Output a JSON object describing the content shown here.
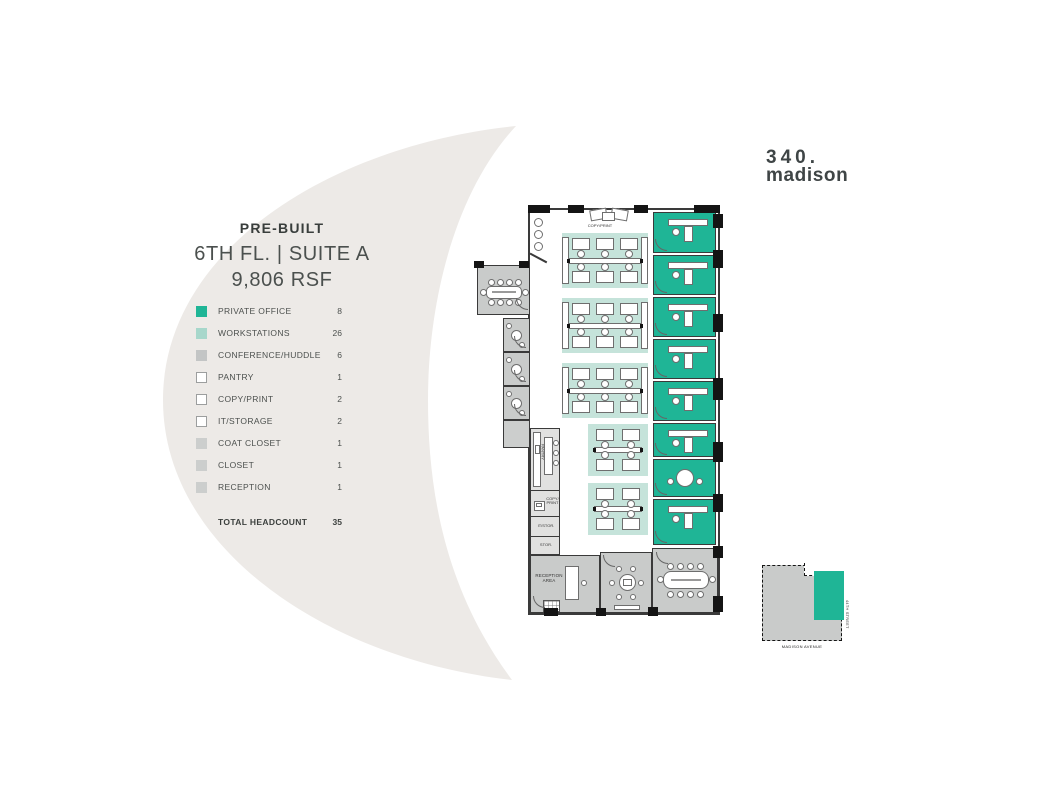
{
  "logo": {
    "line1": "340.",
    "line2": "madison"
  },
  "title": {
    "kicker": "PRE-BUILT",
    "line1": "6TH FL. | SUITE A",
    "line2": "9,806 RSF"
  },
  "legend": {
    "items": [
      {
        "label": "PRIVATE OFFICE",
        "count": "8",
        "swatch": "teal"
      },
      {
        "label": "WORKSTATIONS",
        "count": "26",
        "swatch": "light-teal"
      },
      {
        "label": "CONFERENCE/HUDDLE",
        "count": "6",
        "swatch": "gray"
      },
      {
        "label": "PANTRY",
        "count": "1",
        "swatch": "outline"
      },
      {
        "label": "COPY/PRINT",
        "count": "2",
        "swatch": "outline"
      },
      {
        "label": "IT/STORAGE",
        "count": "2",
        "swatch": "outline"
      },
      {
        "label": "COAT CLOSET",
        "count": "1",
        "swatch": "light-gray"
      },
      {
        "label": "CLOSET",
        "count": "1",
        "swatch": "light-gray"
      },
      {
        "label": "RECEPTION",
        "count": "1",
        "swatch": "light-gray"
      }
    ],
    "total_label": "TOTAL HEADCOUNT",
    "total_count": "35"
  },
  "plan_labels": {
    "copy_print_top": "COPY/PRINT",
    "pantry": "PANTRY",
    "copy_print": "COPY/PRINT",
    "it_storage": "IT/STOR.",
    "storage": "STOR.",
    "reception": "RECEPTION AREA"
  },
  "keyplan": {
    "street_bottom": "MADISON AVENUE",
    "street_right": "44TH STREET"
  },
  "colors": {
    "accent_teal": "#1fb596",
    "workstation_teal": "#c5e3da",
    "legend_workstation_teal": "#a7d7cb",
    "room_gray": "#c9cbca",
    "service_gray": "#e1e1e0",
    "wall": "#3a3a3a",
    "background_shape": "#edeae7"
  }
}
